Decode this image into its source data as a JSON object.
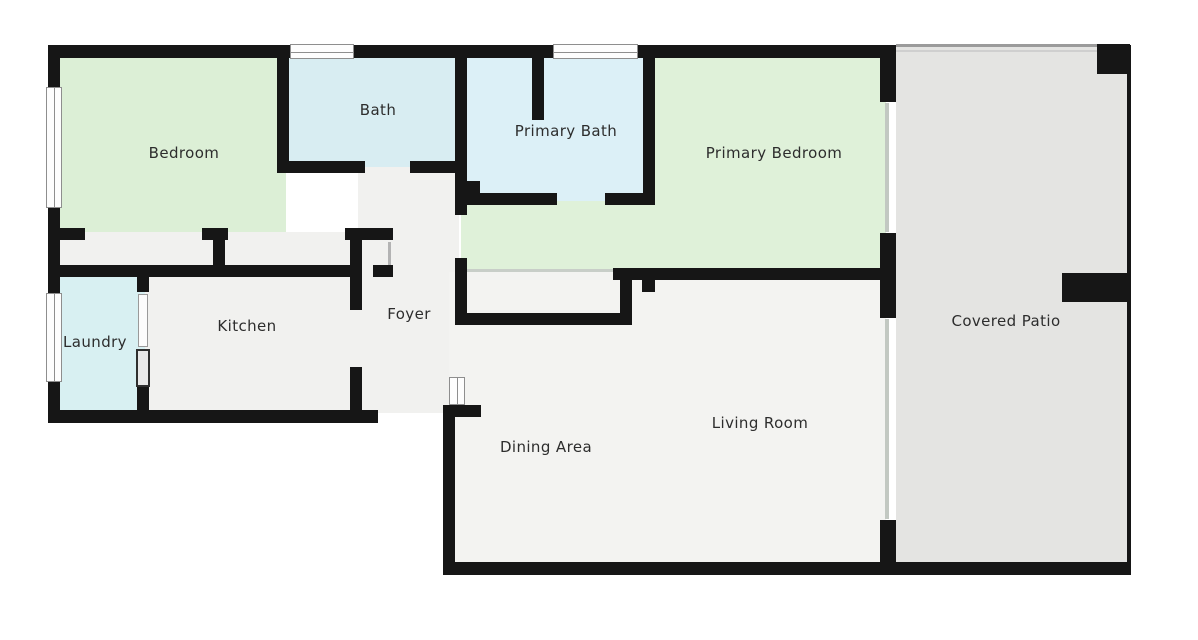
{
  "plan_title": "Floor Plan",
  "rooms": {
    "bedroom": {
      "label": "Bedroom",
      "fill": "#dcefd6"
    },
    "bath": {
      "label": "Bath",
      "fill": "#d8edf2"
    },
    "primary_bath": {
      "label": "Primary Bath",
      "fill": "#dcf0f7"
    },
    "primary_bedroom": {
      "label": "Primary Bedroom",
      "fill": "#dff1d9"
    },
    "covered_patio": {
      "label": "Covered Patio",
      "fill": "#e4e4e2"
    },
    "laundry": {
      "label": "Laundry",
      "fill": "#d8f0f2"
    },
    "kitchen": {
      "label": "Kitchen",
      "fill": "#f1f1ef"
    },
    "foyer": {
      "label": "Foyer",
      "fill": "#f1f1ef"
    },
    "dining_area": {
      "label": "Dining Area",
      "fill": "#f3f3f1"
    },
    "living_room": {
      "label": "Living Room",
      "fill": "#f3f3f1"
    }
  },
  "colors": {
    "wall": "#161616",
    "label_text": "#2d2d2d",
    "background": "#ffffff",
    "window_frame": "#8e8e8e",
    "glass_door_line": "#c2c8c2",
    "patio_edge_line": "#9b9b9b"
  }
}
